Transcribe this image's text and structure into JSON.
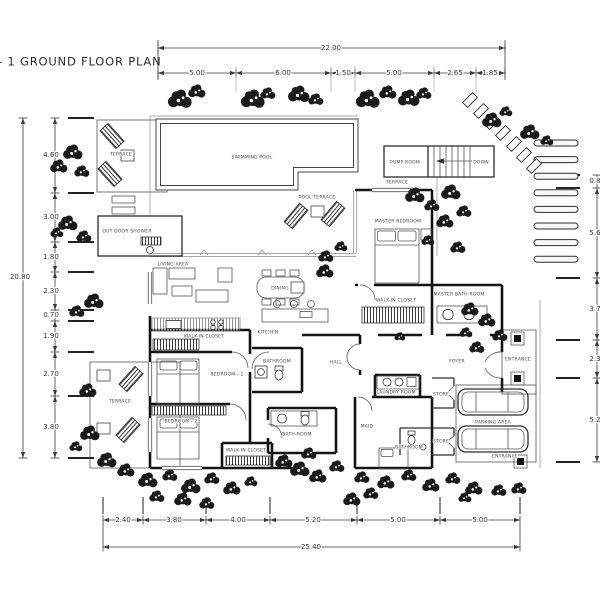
{
  "title": "- 1  GROUND FLOOR PLAN",
  "dimensions": {
    "top": {
      "total": "22.00",
      "segments": [
        "5.00",
        "6.00",
        "1.50",
        "5.00",
        "2.65",
        "1.85"
      ]
    },
    "left": {
      "total": "20.80",
      "segments": [
        "4.60",
        "3.00",
        "1.80",
        "2.30",
        "0.70",
        "1.90",
        "2.70",
        "3.80"
      ]
    },
    "right": {
      "segments": [
        "0.8",
        "5.6",
        "3.7",
        "2.3",
        "5.2"
      ]
    },
    "bottom": {
      "total": "25.40",
      "segments": [
        "2.40",
        "3.80",
        "4.00",
        "5.20",
        "5.00",
        "5.00"
      ]
    }
  },
  "rooms": {
    "swimming_pool": "SWIMMING POOL",
    "pool_terrace": "POOL TERRACE",
    "terrace_upper": "TERRACE",
    "out_door_shower": "OUT DOOR SHOWER",
    "pump_room": "PUMP ROOM",
    "down": "DOWN",
    "terrace_small": "TERRACE",
    "master_bedroom": "MASTER BEDROOM",
    "master_bathroom": "MASTER BATH-ROOM",
    "walk_in_closet_master": "WALK-IN CLOSET",
    "living_area": "LIVING AREA",
    "dining": "DINING",
    "kitchen": "KITCHEN",
    "walk_in_closet_1": "WALK-IN CLOSET",
    "bathroom_1": "BATHROOM",
    "bedroom_1": "BEDROOM - 1",
    "hall": "HALL",
    "foyer": "FOYER",
    "entrance": "ENTRANCE",
    "bedroom_2": "BEDROOM - 2",
    "bath_room_2": "BATH-ROOM",
    "walk_in_closet_2": "WALK-IN CLOSET",
    "terrace_lower": "TERRACE",
    "laundry_room": "LAUNDRY ROOM",
    "store_1": "STORE",
    "store_2": "STORE",
    "maid": "MAID",
    "bathroom_maid": "BATHROOM",
    "parking_area": "PARKING AREA",
    "entrance_2": "ENTRANCE"
  }
}
